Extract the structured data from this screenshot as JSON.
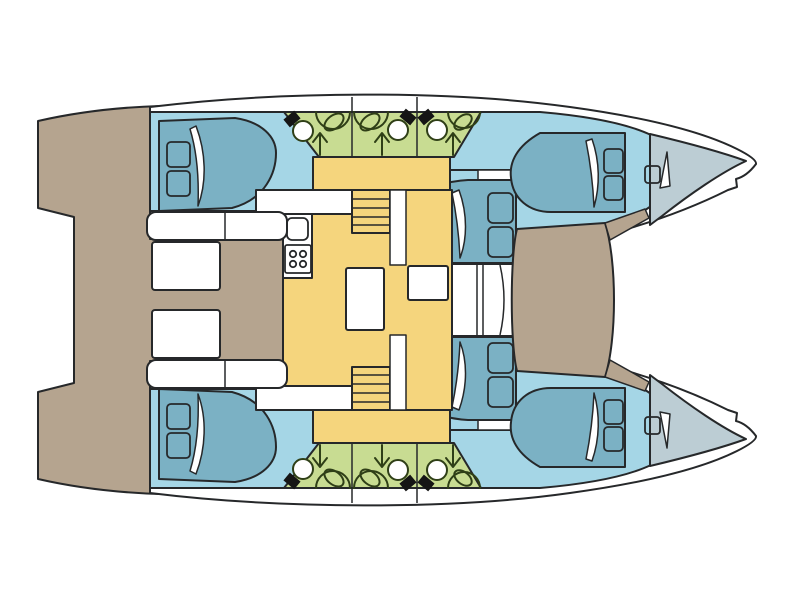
{
  "page": {
    "background": "#ffffff",
    "description": "Catamaran accommodation floor plan, top view, bows pointing right"
  },
  "colors": {
    "outline": "#26282a",
    "hull_white": "#ffffff",
    "deck_taupe": "#b5a48f",
    "cabin_floor_blue": "#a5d6e6",
    "bed_teal": "#7bb1c4",
    "bow_locker_gray": "#bccdd4",
    "bathroom_green": "#c8dc92",
    "bathroom_line": "#2f3f17",
    "saloon_yellow": "#f5d57d",
    "fixture_black": "#151515",
    "furniture_white": "#ffffff"
  },
  "layout": {
    "hulls": 2,
    "cabins_per_hull": 3,
    "heads_per_hull": 3,
    "areas": [
      "cockpit",
      "saloon",
      "galley",
      "stairs",
      "foredeck",
      "bow-locker"
    ]
  },
  "fixtures": {
    "head_unit": [
      "toilet",
      "sink",
      "shower-arrow",
      "shower-curve"
    ],
    "galley": [
      "sink",
      "stove-4-burner"
    ],
    "stair_treads": 4,
    "pillows_per_bed": 2
  }
}
